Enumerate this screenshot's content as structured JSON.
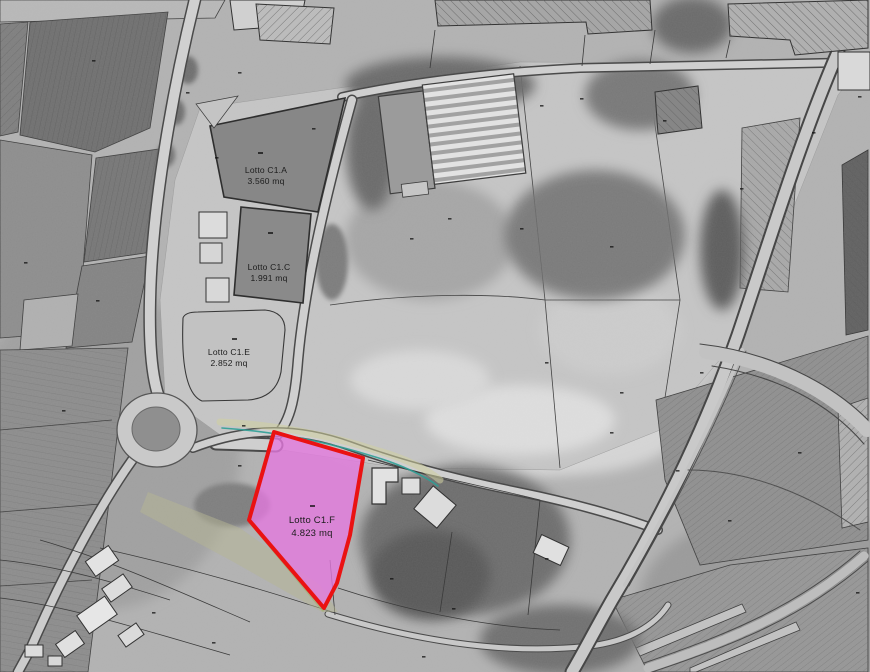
{
  "map": {
    "kind": "cadastral-plan-over-aerial-photo",
    "highlighted_lot": "Lotto C1.F"
  },
  "lots": [
    {
      "name": "Lotto C1.A",
      "area": "3.560 mq"
    },
    {
      "name": "Lotto C1.C",
      "area": "1.991 mq"
    },
    {
      "name": "Lotto C1.E",
      "area": "2.852 mq"
    },
    {
      "name": "Lotto C1.F",
      "area": "4.823 mq"
    }
  ],
  "colors": {
    "highlight_fill": "#E678E0",
    "highlight_border": "#EA1212",
    "utility_teal": "#2F9E96"
  }
}
